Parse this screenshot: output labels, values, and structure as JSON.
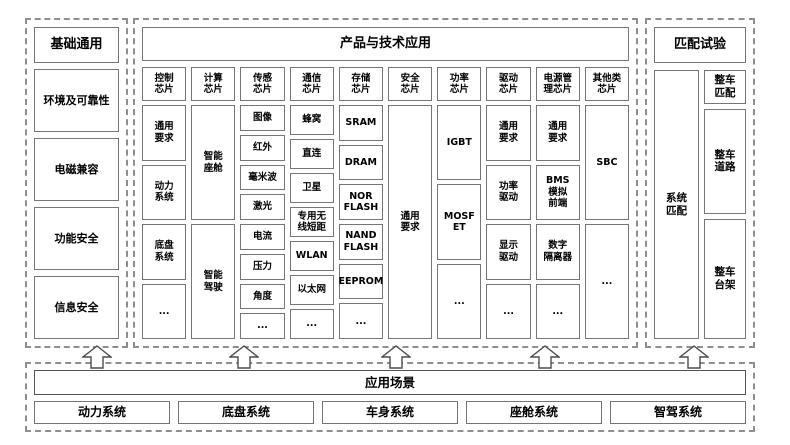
{
  "left_panel": {
    "title": "基础通用",
    "items": [
      "环境及可靠性",
      "电磁兼容",
      "功能安全",
      "信息安全"
    ]
  },
  "center_panel": {
    "title": "产品与技术应用",
    "columns": [
      {
        "header": "控制\n芯片",
        "items": [
          "通用\n要求",
          "动力\n系统",
          "底盘\n系统",
          "..."
        ]
      },
      {
        "header": "计算\n芯片",
        "items": [
          "智能\n座舱",
          "智能\n驾驶"
        ]
      },
      {
        "header": "传感\n芯片",
        "items": [
          "图像",
          "红外",
          "毫米波",
          "激光",
          "电流",
          "压力",
          "角度",
          "..."
        ]
      },
      {
        "header": "通信\n芯片",
        "items": [
          "蜂窝",
          "直连",
          "卫星",
          "专用无\n线短距",
          "WLAN",
          "以太网",
          "..."
        ]
      },
      {
        "header": "存储\n芯片",
        "items": [
          "SRAM",
          "DRAM",
          "NOR\nFLASH",
          "NAND\nFLASH",
          "EEPROM",
          "..."
        ]
      },
      {
        "header": "安全\n芯片",
        "items": [
          "通用\n要求"
        ]
      },
      {
        "header": "功率\n芯片",
        "items": [
          "IGBT",
          "MOSF\nET",
          "..."
        ]
      },
      {
        "header": "驱动\n芯片",
        "items": [
          "通用\n要求",
          "功率\n驱动",
          "显示\n驱动",
          "..."
        ]
      },
      {
        "header": "电源管\n理芯片",
        "items": [
          "通用\n要求",
          "BMS\n模拟\n前端",
          "数字\n隔离器",
          "..."
        ]
      },
      {
        "header": "其他类\n芯片",
        "items": [
          "SBC",
          "..."
        ]
      }
    ]
  },
  "right_panel": {
    "title": "匹配试验",
    "side_item": "系统\n匹配",
    "items": [
      "整车\n匹配",
      "整车\n道路",
      "整车\n台架"
    ]
  },
  "bottom_panel": {
    "bar": "应用场景",
    "items": [
      "动力系统",
      "底盘系统",
      "车身系统",
      "座舱系统",
      "智驾系统"
    ]
  },
  "icons": {
    "flow_arrow": "hollow-up-arrow"
  },
  "colors": {
    "background": "#ffffff",
    "box_border": "#767676",
    "dashed_border": "#8f8f8f",
    "text": "#000000"
  }
}
